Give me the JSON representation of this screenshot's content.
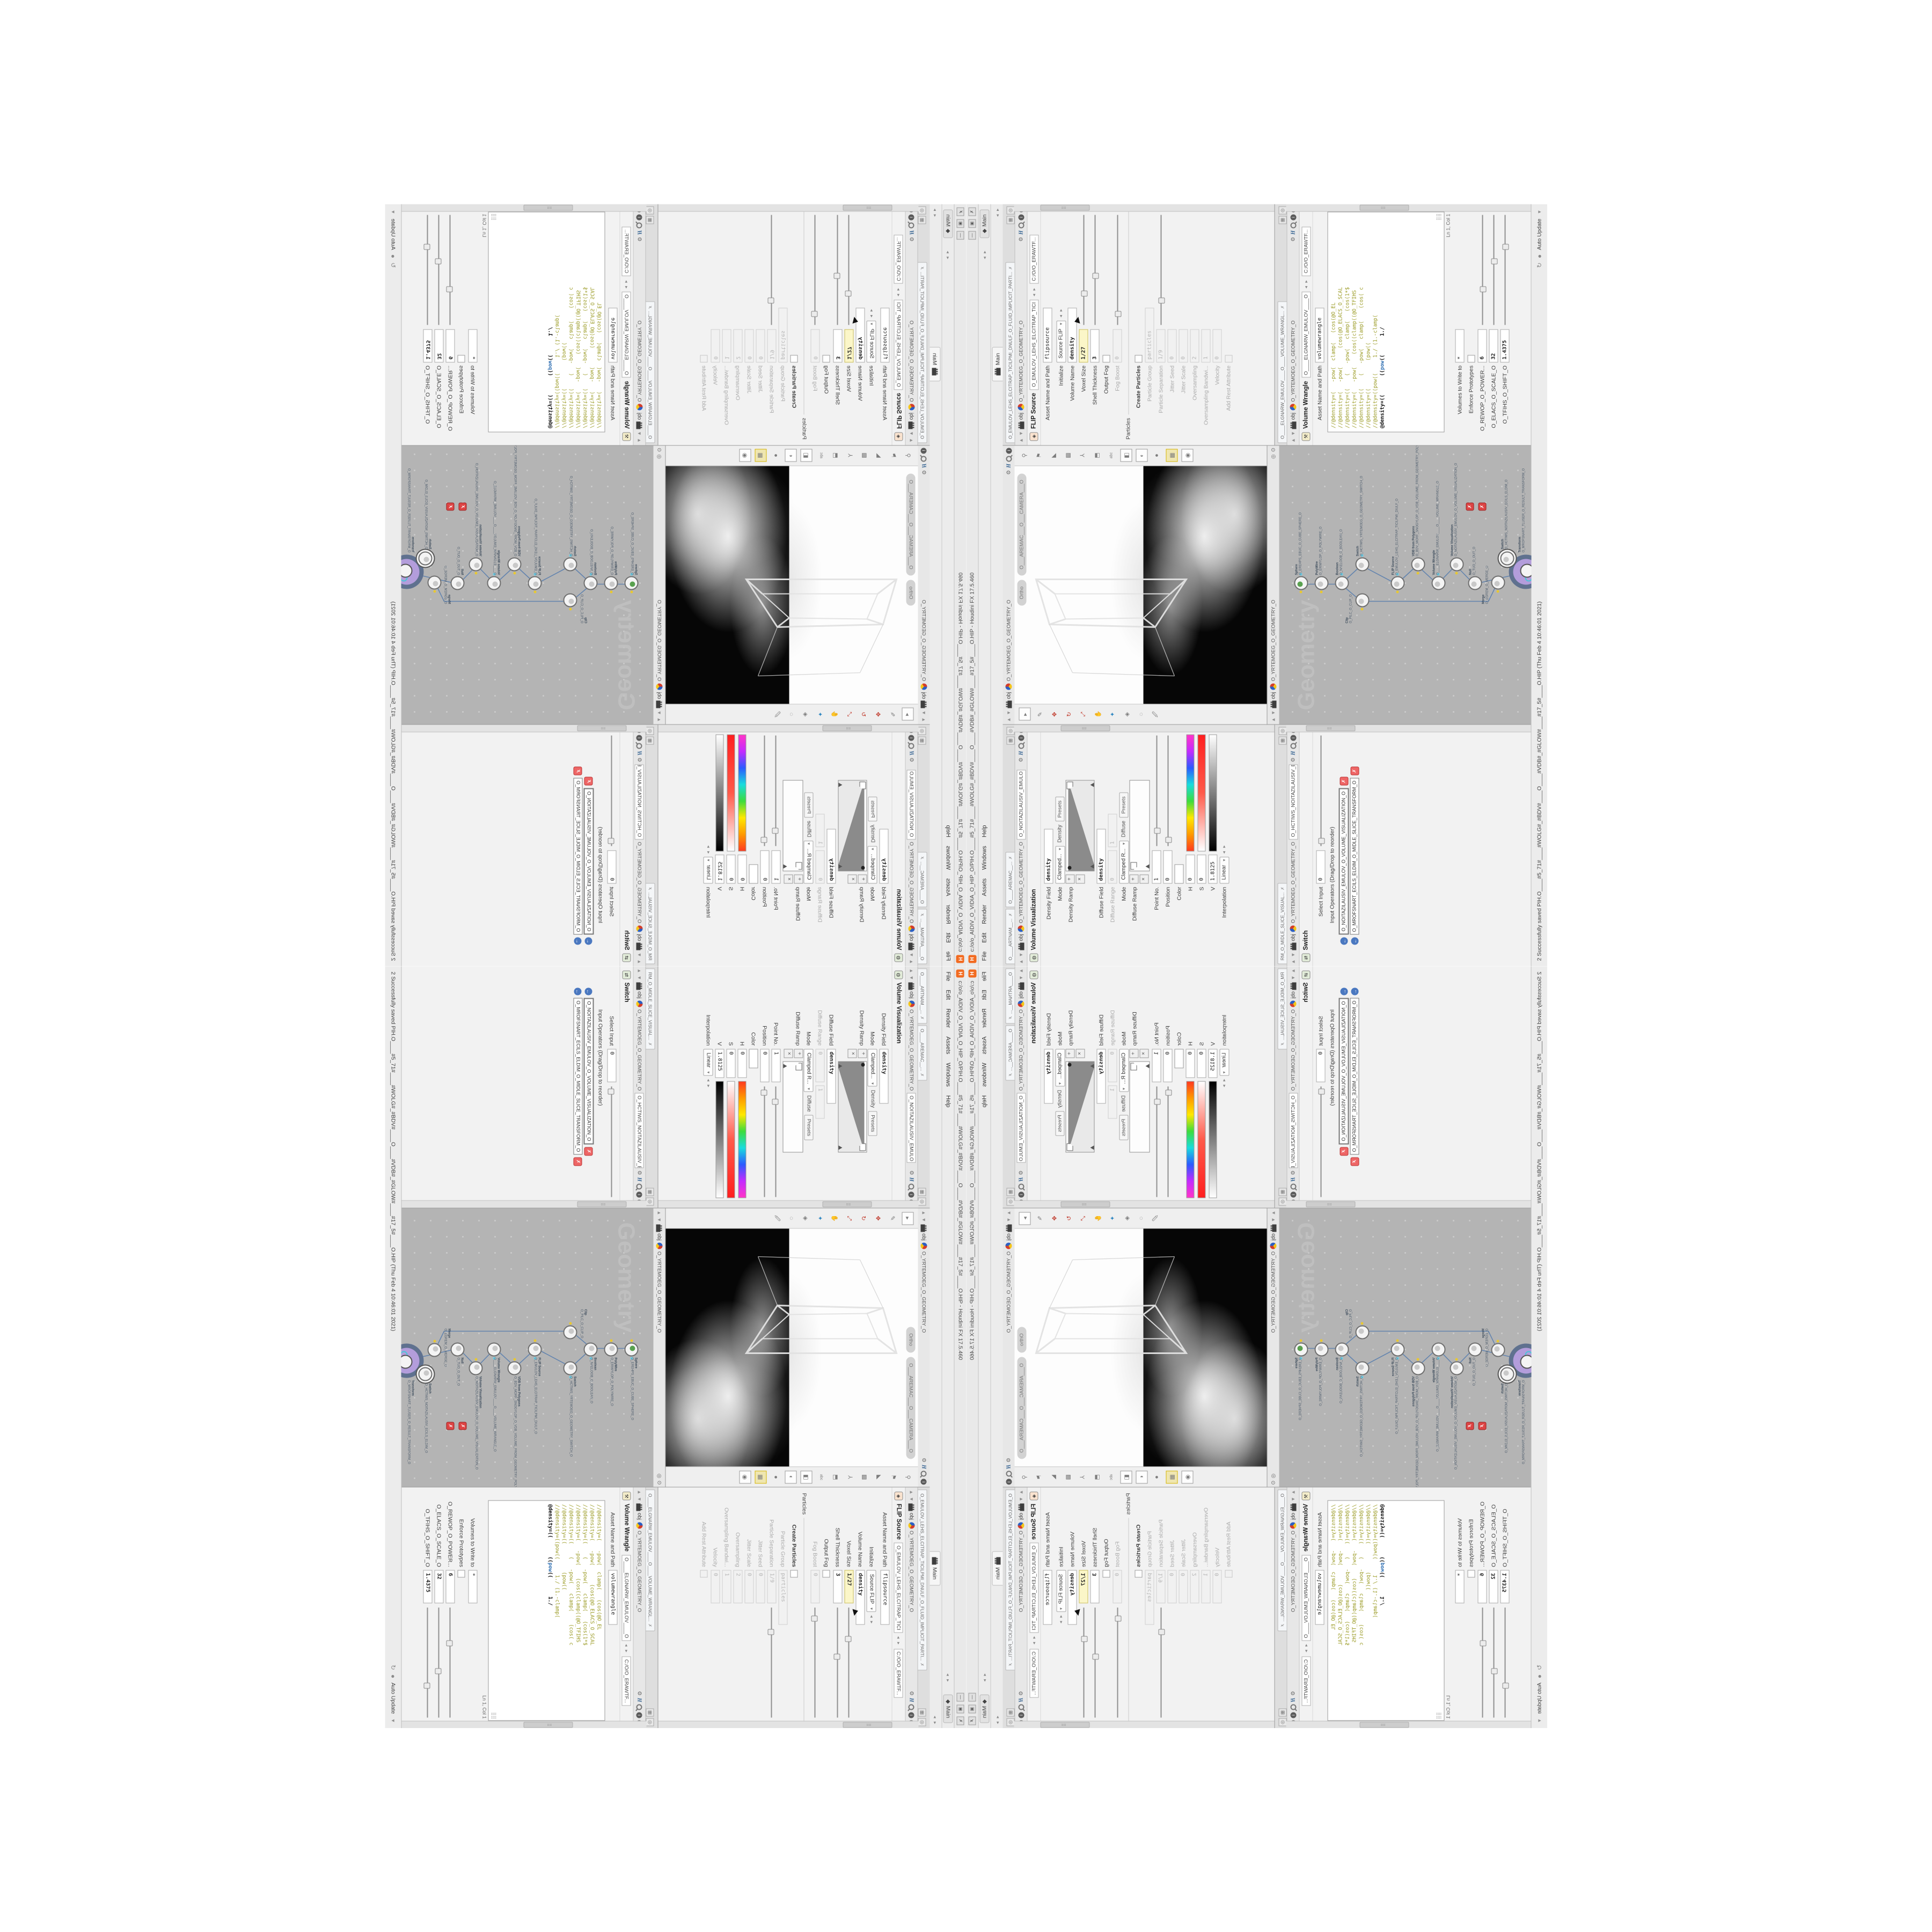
{
  "colors": {
    "accent_orange": "#f26b21",
    "selected_node_ring": "#5f718f",
    "selected_node_fill": "#b39ddb",
    "keyframe_yellow": "#fbf6c8",
    "network_bg": "#b4b4b4",
    "viewport_black": "#060606",
    "code_comment": "#9a9a23"
  },
  "window": {
    "title": "c:/o/o_AIDIV_O_VIDIA_O_HIP_O/PIH.O____#5_71#____#WOLG#_#BDV#____O____#VDB#_#GLOW#____#17_5#____O.HIP - Houdini FX 17.5.460",
    "logo_glyph": "H",
    "buttons": {
      "min": "—",
      "max": "▣",
      "close": "✗"
    },
    "menu": [
      "File",
      "Edit",
      "Render",
      "Assets",
      "Windows",
      "Help"
    ],
    "desktop_label": "Main",
    "desktop_icon": "◆",
    "shelf_tab": "Main",
    "status_message": "2 Successfully saved PIH.O____#5_71#____#WOLG#_#BDV#____O____#VDB#_#GLOW#____#17_5#____O.HIP (Thu Feb 4 10:46:01 2021)",
    "status_autoupdate": "Auto Update"
  },
  "icons": {
    "up": "▲",
    "down": "▼",
    "left": "◂",
    "right": "▸",
    "pair": "◂ ▸",
    "gear": "⚙",
    "h": "H",
    "info": "i",
    "help": "?",
    "target": "◎",
    "close": "✗",
    "play": "▶",
    "back": "←",
    "refresh": "↻",
    "sphere": "●",
    "grid": "▦",
    "pin": "⊙",
    "plus": "+",
    "times": "×",
    "flagtri": "▲",
    "grip": "⣿⣿"
  },
  "chrome": {
    "obj": "obj",
    "geo_path": "O_YRTEMOEG_O_GEOMETRY_O",
    "file_path": "C:/O/O_ERAWTF..."
  },
  "viz_pane": {
    "tabs": [
      "O____ARTNAM__...",
      "O____AREMAC__..."
    ],
    "node_field": "O_NOITAZILAUSIV_EMULO",
    "title": "Volume Visualization",
    "node_icon": "◍",
    "p_density_field": {
      "label": "Density Field",
      "value": "density"
    },
    "p_mode1": {
      "label": "Mode",
      "value": "Clamped...",
      "sub": "Density",
      "presets": "Presets"
    },
    "p_density_ramp": {
      "label": "Density Ramp"
    },
    "p_diffuse_field": {
      "label": "Diffuse Field",
      "value": "density"
    },
    "p_diffuse_range": {
      "label": "Diffuse Range",
      "v0": "0",
      "v1": "1"
    },
    "p_mode2": {
      "label": "Mode",
      "value": "Clamped R...",
      "sub": "Diffuse",
      "presets": "Presets"
    },
    "p_diffuse_ramp": {
      "label": "Diffuse Ramp"
    },
    "p_point": {
      "label": "Point No.",
      "value": "1"
    },
    "p_position": {
      "label": "Position",
      "value": "0"
    },
    "p_color": {
      "label": "Color"
    },
    "p_h": {
      "label": "H",
      "value": "0"
    },
    "p_s": {
      "label": "S",
      "value": "0"
    },
    "p_v": {
      "label": "V",
      "value": "1.8125"
    },
    "p_interp": {
      "label": "Interpolation",
      "value": "Linear"
    }
  },
  "switch_pane": {
    "tabs": [
      "RM_O_MIDLE_SLICE_VISUAL..."
    ],
    "node_field": "O_HCTIWS_NOITAZILAUSIV_ECILS_EL",
    "title": "Switch",
    "node_icon": "⇄",
    "p_select": {
      "label": "Select Input",
      "value": "0"
    },
    "ops_label": "Input Operators (Drag/Drop to reorder)",
    "ops": [
      "O_NOITAZILAUSIV_EMULOV_O_VOLUME_VISUALIZATION_O",
      "O_MROFSNART_ECILS_ELDIM_O_MIDLE_SLICE_TRANSFORM_O"
    ]
  },
  "viewport": {
    "cam_pill": "O___AREMAC___O___CAMERA___O",
    "view_pill": "Ortho",
    "path": "O_YRTEMOEG_O_GEOMETRY_O"
  },
  "network": {
    "watermark": "Geometry",
    "path": "O_YRTEMOEG_O_GEOMETRY_O",
    "nodes": [
      {
        "type": "Sphere",
        "name": "O_EREHPS_EBUC_O_CUBE_SPHERE_O"
      },
      {
        "type": "PolyWire",
        "name": "O_ERIWYLOP_O_POLYWIRE_O"
      },
      {
        "type": "Boolean",
        "name": "O_NAELOOB_O_BOOLEAN_O"
      },
      {
        "type": "Clip",
        "name": "O_PILC_O_CLIP_O"
      },
      {
        "type": "Switch",
        "name": "O_HCTIWS_YRTEMOEG_O_GEOMETRY_SWITCH_O"
      },
      {
        "type": "FLIP Source",
        "name": "O_EMULOV_LEHS_ELCITRAP_TICILPMI_DIULF_O"
      },
      {
        "type": "VDB from Polygons",
        "name": "O_BDV_MORF_SNOGYLOP_O_VDB_VOLUME_FROM_GEOMETRY_POLYG_O"
      },
      {
        "type": "Volume Wrangle",
        "name": "O____ELGNARW_EMULOV____O____VOLUME_WRANGLE_O"
      },
      {
        "type": "Volume Visualization",
        "name": "O_NOITAZILAUSIV_EMULOV_O_VOLUME_VISUALIZATION_O"
      },
      {
        "type": "Null",
        "name": "O_TUO_O_OUT_O"
      },
      {
        "type": "Merge",
        "name": "O_EGREM_O_MERGE_O"
      },
      {
        "type": "Switch",
        "name": "O_HCTIWS_NOITAZILAUSIV_ECILS_ELDIM_O"
      },
      {
        "type": "Transform",
        "name": "O_MROFSNART_TLUSER_O_RESULT_TRANSFORM_O"
      }
    ]
  },
  "flip_pane": {
    "tab": "O_EMULOV_LEHS_ELCITRAP_TICILPMI_DNULF_O_FLUID_IMPLICIT_PARTI...",
    "title": "FLIP Source",
    "name_field": "O_EMULOV_LEHS_ELCITRAP_TICI",
    "file_path": "C:/O/O_ERAWTF...",
    "asset_label": "Asset Name and Path",
    "asset_value": "flipsource",
    "p_initialize": {
      "label": "Initialize",
      "value": "Source FLIP"
    },
    "p_volume_name": {
      "label": "Volume Name",
      "value": "density"
    },
    "p_voxel_size": {
      "label": "Voxel Size",
      "value": "1/27"
    },
    "p_shell": {
      "label": "Shell Thickness",
      "value": "3"
    },
    "p_output_fog": {
      "label": "Output Fog"
    },
    "p_fog_boost": {
      "label": "Fog Boost",
      "value": "0"
    },
    "section_particles": "Particles",
    "p_create": {
      "label": "Create Particles"
    },
    "p_group": {
      "label": "Particle Group",
      "value": "particles"
    },
    "p_sep": {
      "label": "Particle Separation",
      "value": "1/9"
    },
    "p_jseed": {
      "label": "Jitter Seed",
      "value": "0"
    },
    "p_jscale": {
      "label": "Jitter Scale",
      "value": "0"
    },
    "p_oversamp": {
      "label": "Oversampling",
      "value": "2"
    },
    "p_oversampbw": {
      "label": "Oversampling Bandwi...",
      "value": "1"
    },
    "p_velocity": {
      "label": "Velocity",
      "value": "0"
    },
    "p_rest": {
      "label": "Add Rest Attribute"
    }
  },
  "wrangle_pane": {
    "tab": "O____ELGNARW_EMULOV____O____VOLUME_WRANGL...",
    "title": "Volume Wrangle",
    "name_field": "O____ELGNARW_EMULOV____O",
    "file_path": "C:/O/O_ERAWTF...",
    "asset_label": "Asset Name and Path",
    "asset_value": "volumewrangle",
    "code": [
      "//@density=(   -pow(  clamp(   (cos(@O_EL",
      "//@density=(   -pow(      (cos(@O_ELACS_O_SCAL",
      "",
      "//@density=((    (   -pow(   clamp(   (cos(1*$",
      "//@density=(   -pow(    (cos((clamp((@O_TFIHS",
      "",
      "//@density=((    (   -pow(   clamp(    (cos( c",
      "",
      "//@density=((         (pow((",
      "//@density=((pow((     1./ (1.-clamp(",
      ""
    ],
    "code_active": {
      "a": "@density=((      ((",
      "kw": "pow",
      "b": "((      1./"
    },
    "ln_col": "Ln 1, Col 1",
    "p_volumes": {
      "label": "Volumes to Write to",
      "value": "*"
    },
    "p_enforce": {
      "label": "Enforce Prototypes"
    },
    "p_power": {
      "label": "O_REWOP_O_POWER...",
      "value": "6"
    },
    "p_scale": {
      "label": "O_ELACS_O_SCALE_O",
      "value": "32"
    },
    "p_shift": {
      "label": "O_TFIHS_O_SHIFT_O",
      "value": "1.4375"
    }
  }
}
